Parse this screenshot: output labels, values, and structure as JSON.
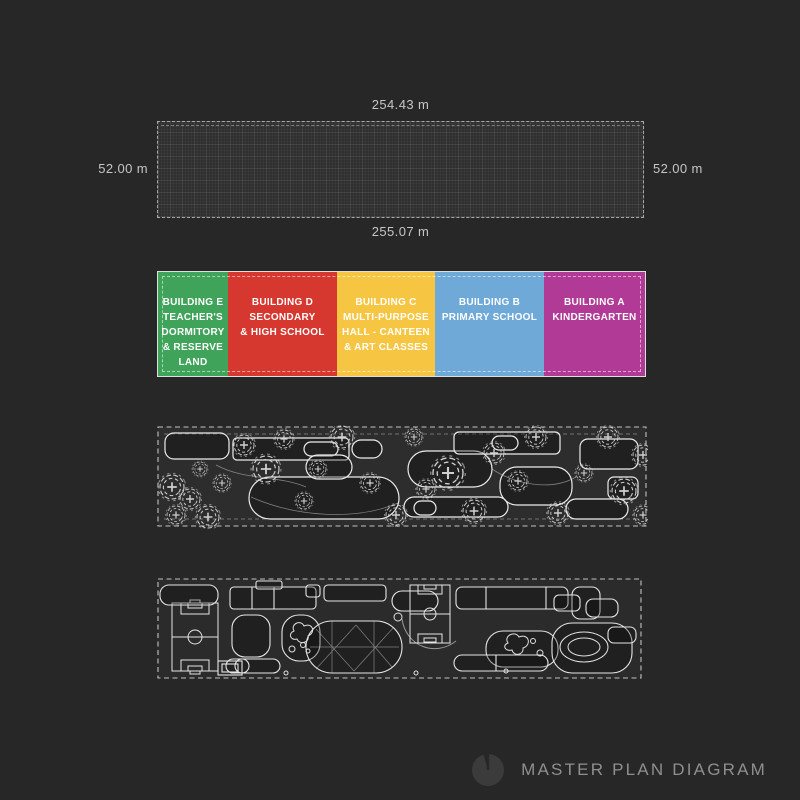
{
  "page": {
    "background": "#272727"
  },
  "site_plan": {
    "dim_top": "254.43 m",
    "dim_left": "52.00 m",
    "dim_right": "52.00 m",
    "dim_bottom": "255.07 m"
  },
  "legend": {
    "buildings": [
      {
        "id": "E",
        "label": "BUILDING E\nTEACHER'S\nDORMITORY\n& RESERVE\nLAND",
        "color": "#3fa35a"
      },
      {
        "id": "D",
        "label": "BUILDING D\nSECONDARY\n& HIGH SCHOOL",
        "color": "#d6382f"
      },
      {
        "id": "C",
        "label": "BUILDING C\nMULTI-PURPOSE\nHALL - CANTEEN\n& ART CLASSES",
        "color": "#f6c642"
      },
      {
        "id": "B",
        "label": "BUILDING B\nPRIMARY SCHOOL",
        "color": "#6ea9d8"
      },
      {
        "id": "A",
        "label": "BUILDING A\nKINDERGARTEN",
        "color": "#b13a96"
      }
    ]
  },
  "footer": {
    "title": "MASTER PLAN DIAGRAM",
    "logo_icon": "pie-clock-logo",
    "logo_color": "#3b3b3b"
  }
}
